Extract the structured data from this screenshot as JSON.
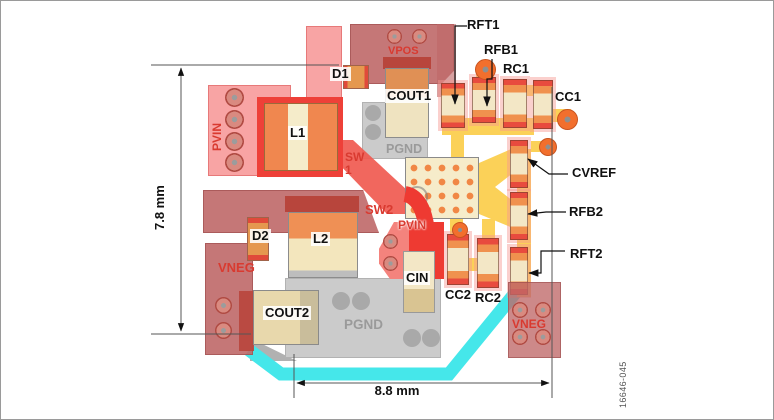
{
  "figure": {
    "type": "pcb-layout-diagram",
    "number": "16646-045"
  },
  "dimensions": {
    "height_label": "7.8 mm",
    "width_label": "8.8 mm"
  },
  "board": {
    "nets": {
      "vpos": "VPOS",
      "pvin_left": "PVIN",
      "pvin_center": "PVIN",
      "sw1_line1": "SW",
      "sw1_line2": "1",
      "sw2": "SW2",
      "vneg_left": "VNEG",
      "vneg_right": "VNEG",
      "pgnd_top": "PGND",
      "pgnd_bottom": "PGND"
    },
    "components": {
      "d1": "D1",
      "l1": "L1",
      "cout1": "COUT1",
      "d2": "D2",
      "l2": "L2",
      "cout2": "COUT2",
      "cin": "CIN",
      "cc2": "CC2",
      "rc2": "RC2"
    },
    "callouts": {
      "rft1": "RFT1",
      "rfb1": "RFB1",
      "rc1": "RC1",
      "cc1": "CC1",
      "cvref": "CVREF",
      "rfb2": "RFB2",
      "rft2": "RFT2"
    }
  },
  "colors": {
    "copper_pink": "#f79c9c",
    "copper_mauve": "#bf6868",
    "copper_red": "#ee3a32",
    "component_orange": "#f0914e",
    "component_cream": "#f3e7c6",
    "ground_gray": "#cbcbcb",
    "trace_yellow": "#fbd158",
    "trace_cyan": "#45e7ea",
    "silkscreen_red": "#d93a30",
    "annotation_black": "#111111"
  }
}
